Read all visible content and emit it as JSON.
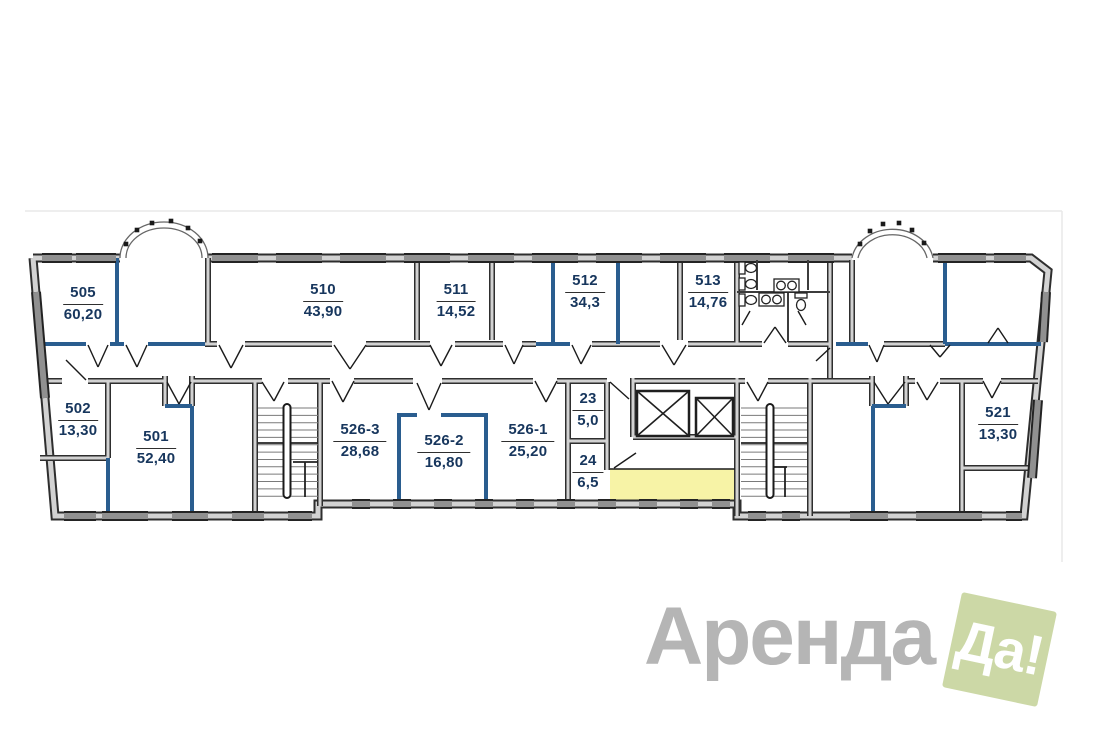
{
  "plan": {
    "rooms": [
      {
        "id": "505",
        "area": "60,20"
      },
      {
        "id": "510",
        "area": "43,90"
      },
      {
        "id": "511",
        "area": "14,52"
      },
      {
        "id": "512",
        "area": "34,3"
      },
      {
        "id": "513",
        "area": "14,76"
      },
      {
        "id": "502",
        "area": "13,30"
      },
      {
        "id": "501",
        "area": "52,40"
      },
      {
        "id": "526-3",
        "area": "28,68"
      },
      {
        "id": "526-2",
        "area": "16,80"
      },
      {
        "id": "526-1",
        "area": "25,20"
      },
      {
        "id": "23",
        "area": "5,0"
      },
      {
        "id": "24",
        "area": "6,5"
      },
      {
        "id": "521",
        "area": "13,30"
      }
    ],
    "colors": {
      "wall_blue": "#2a5d8f",
      "highlight": "#f7f3a6",
      "label_text": "#17365d"
    }
  },
  "watermark": {
    "brand": "Аренда",
    "badge": "Да!",
    "brand_color": "#b5b5b5",
    "badge_bg": "#ccd8a6",
    "badge_text_color": "#ffffff"
  }
}
